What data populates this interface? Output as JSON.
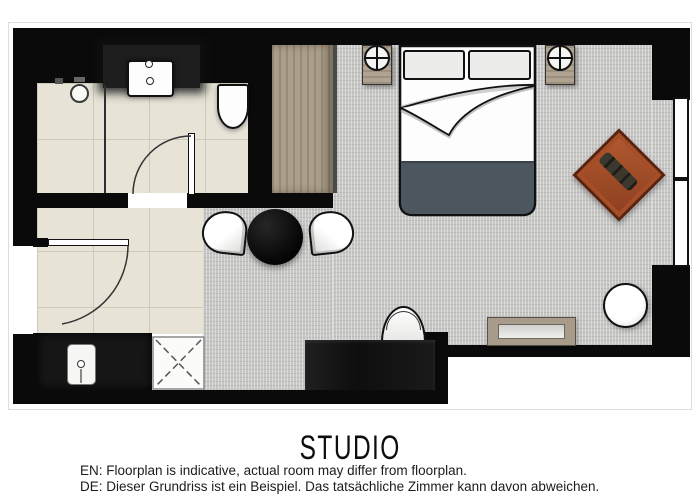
{
  "floorplan": {
    "title": "STUDIO",
    "disclaimer_en": "EN: Floorplan is indicative, actual room may differ from floorplan.",
    "disclaimer_de": "DE: Dieser Grundriss ist ein Beispiel. Das tatsächliche Zimmer kann davon abweichen.",
    "colors": {
      "wall": "#0a0a0a",
      "tile_floor": "#e7e3d7",
      "carpet": "#c6c6c4",
      "wood": "#ab9e8a",
      "armchair": "#a74d28",
      "bed_blanket": "#4c565e",
      "desk": "#1d1d1d"
    },
    "furniture": [
      "shower",
      "sink",
      "toilet",
      "bathroom-door",
      "entry-door",
      "wardrobe",
      "double-bed",
      "pillows",
      "nightstand-left",
      "nightstand-right",
      "lamps",
      "armchair",
      "window",
      "dining-table",
      "dining-chairs",
      "desk",
      "desk-chair",
      "bench",
      "stool",
      "luggage-rack",
      "minibar-appliance"
    ]
  }
}
